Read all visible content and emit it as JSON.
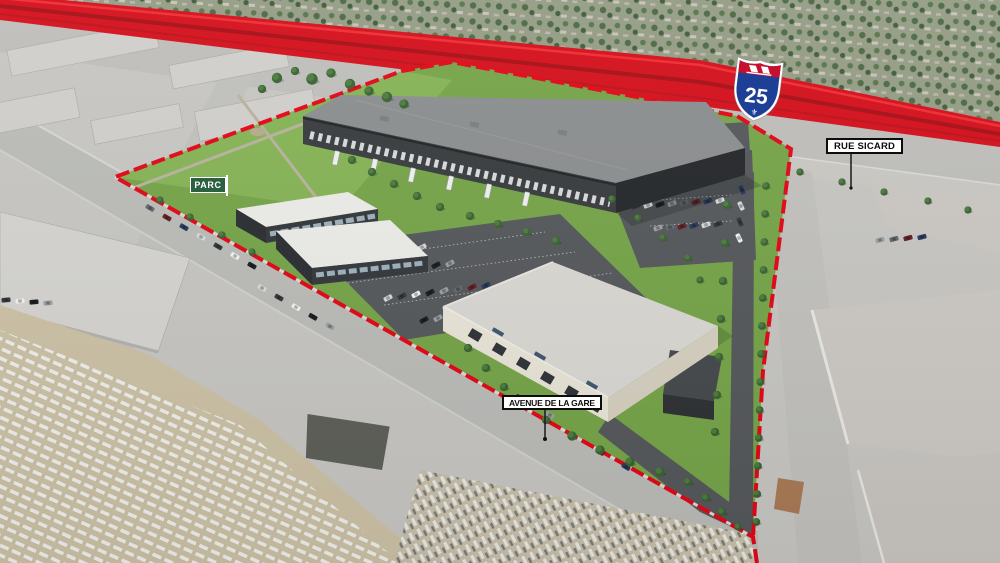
{
  "scene": {
    "labels": {
      "park": "PARC",
      "avenue_de_la_gare": "AVENUE DE LA GARE",
      "rue_sicard": "RUE SICARD"
    },
    "highway_shield": {
      "number": "25",
      "fleur_de_lis_icon": "⚜"
    },
    "colors": {
      "boundary_red": "#e30617",
      "highway_red": "#d40f1b",
      "park_label_green": "#2d5f41",
      "site_grass": "#76a449",
      "park_grass": "#85b355",
      "asphalt": "#55585b"
    }
  }
}
